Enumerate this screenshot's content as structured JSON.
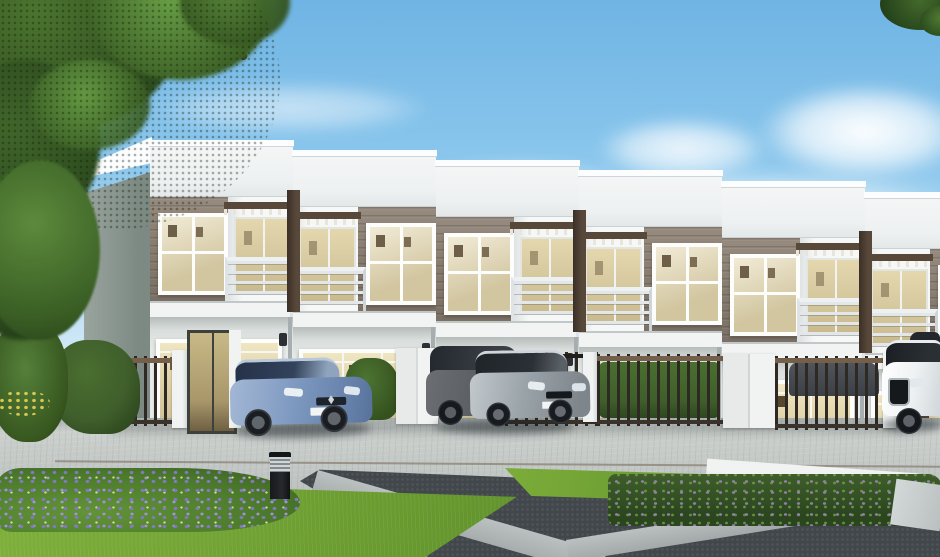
{
  "image": {
    "type": "3d-architectural-rendering",
    "subject": "Modern two-story townhouse row with landscaped driveway and parked cars",
    "width_px": 940,
    "height_px": 557,
    "visible_text": "none"
  },
  "scene": {
    "sky": {
      "condition": "clear daytime sky with soft white clouds",
      "cloud_count": 5
    },
    "building": {
      "type": "townhouse row",
      "stories": 2,
      "visible_units": 6,
      "roof": "flat stepped white parapet descending to the right",
      "upper_floor": "taupe horizontal siding with white-framed windows, recessed balconies with metal railings, pergola slats and dark brown vertical fins",
      "ground_floor": "light wall with large warm-lit sliding windows, wall sconces and downpipes",
      "left_end_wall": "plain gray-green side elevation"
    },
    "site": {
      "fences": "dark metal picket fences with bronze rails, white pillars and white gate panels",
      "hedges": "clipped green hedges behind fences and at left end",
      "driveway": "light gray paver driveway",
      "plaza": "charcoal stone inlay panels crossed by light concrete bands",
      "planter": "raised planter with flowering shrubs and white stone curb",
      "lawn": "bright green lawn wedge in foreground",
      "flower_bed": "purple flowering ground cover at lower left",
      "bollard_light_count": 1
    },
    "vehicles": [
      {
        "type": "hatchback",
        "color_name": "light blue",
        "position": "left driveway bay"
      },
      {
        "type": "hatchback",
        "color_name": "dark gray",
        "position": "center driveway bay"
      },
      {
        "type": "hatchback",
        "color_name": "silver",
        "position": "center driveway bay"
      },
      {
        "type": "sedan",
        "color_name": "dark gray",
        "position": "behind right fence"
      },
      {
        "type": "suv",
        "color_name": "white",
        "position": "right carport"
      },
      {
        "type": "hatchback",
        "color_name": "gray",
        "position": "far right edge"
      }
    ],
    "vegetation": {
      "large_tree": "overhanging canopy in top-left corner",
      "corner_leaves": "small leaf cluster in top-right corner",
      "bushes": "dense bushes with yellow flowers at far left"
    }
  },
  "palette": {
    "sky-top": "#6fb4e4",
    "sky-mid": "#8ac6ec",
    "sky-low": "#b5dcf3",
    "sky-horizon": "#dcedf8",
    "cloud": "#ffffff",
    "fascia": "#f4f6f6",
    "fascia-cap": "#fbfdfe",
    "siding": "#978b7f",
    "siding-dark": "#7b7065",
    "fin": "#57483a",
    "balcony-wall": "#f6f7f7",
    "railing": "#e3e7e9",
    "glass-warm": "#e4d7ae",
    "glass-warm-deep": "#c9ba8e",
    "glass-car": "#33435c",
    "frame-white": "#fdfdfc",
    "pic-frame": "#6e5f49",
    "slab": "#f2f4f3",
    "wall-lower": "#e6eae9",
    "sconce": "#2c3034",
    "pipe": "#a7aeb0",
    "side-wall": "#7d8a83",
    "side-wall-light": "#9aa49e",
    "pillar-white": "#f1f3f2",
    "fence-dark": "#2e2a23",
    "fence-rail": "#74604a",
    "hedge": "#3f5e2b",
    "hedge-dark": "#2b451f",
    "paver": "#cbd0cd",
    "paver-dark": "#b6bcba",
    "seam": "#8d8578",
    "charcoal": "#42474b",
    "concrete-band": "#bac1c0",
    "curb-white": "#f0f3f1",
    "grass": "#7fb03c",
    "grass-dark": "#53842a",
    "flower-purple": "#8379c0",
    "flower-green": "#629336",
    "flower-yellow": "#d9c94e",
    "leaf": "#4c742f",
    "leaf-dark": "#2c4a1e",
    "leaf-light": "#69a046",
    "trunk": "#3a3022",
    "car-blue": "#7e99c0",
    "car-silver": "#9aa3a9",
    "car-gray": "#565a5e",
    "car-dark": "#3a4045",
    "car-white": "#eef1f2",
    "plate": "#f3f5f4",
    "bollard": "#26292d",
    "bollard-band": "#cfd4d6"
  }
}
